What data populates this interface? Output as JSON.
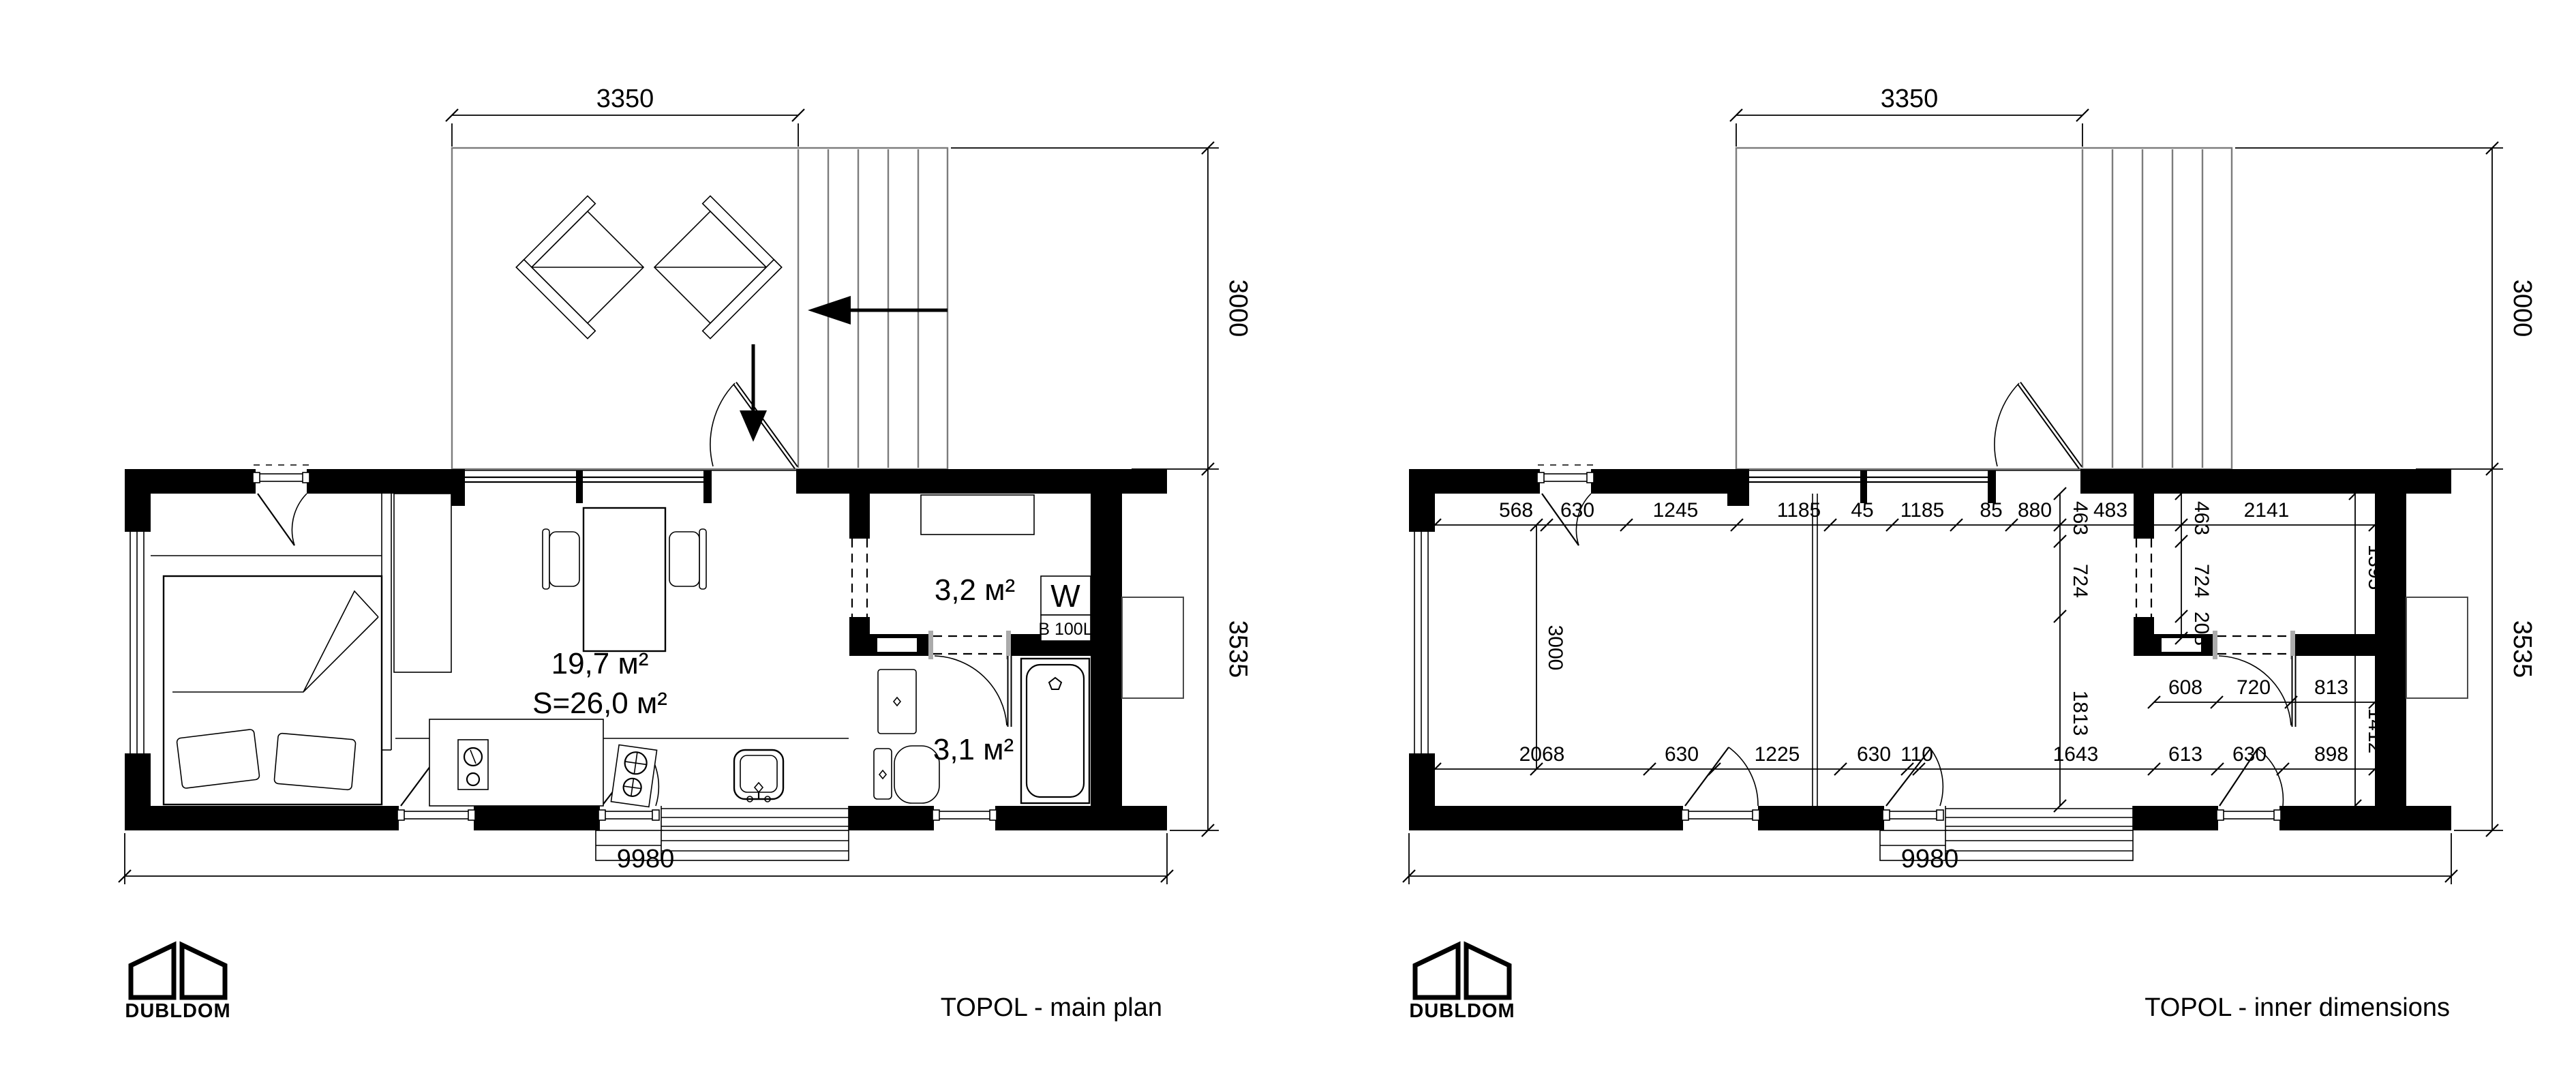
{
  "logo": {
    "name": "DUBLDOM"
  },
  "left": {
    "title": "TOPOL - main plan",
    "dim_terrace_width": "3350",
    "dim_terrace_depth": "3000",
    "dim_house_depth": "3535",
    "dim_total_width": "9980",
    "label_living": "19,7 м²",
    "label_total": "S=26,0 м²",
    "label_hall": "3,2 м²",
    "label_bath": "3,1 м²",
    "label_boiler": "W",
    "label_boiler_volume": "B 100L"
  },
  "right": {
    "title": "TOPOL - inner dimensions",
    "dim_terrace_width": "3350",
    "dim_terrace_depth": "3000",
    "dim_house_depth": "3535",
    "dim_total_width": "9980",
    "dim_room_width": "3000",
    "top_chain": [
      "568",
      "630",
      "1245",
      "1185",
      "45",
      "1185",
      "85",
      "880"
    ],
    "hall_top_chain": [
      "483",
      "2141"
    ],
    "left_v_chain": [
      "463",
      "724",
      "1813"
    ],
    "mid_v_chain": [
      "463",
      "724",
      "208"
    ],
    "right_v_chain": [
      "1395",
      "1412"
    ],
    "bath_top_chain": [
      "608",
      "720",
      "813"
    ],
    "bottom_chain": [
      "2068",
      "630",
      "1225",
      "630",
      "110",
      "1643"
    ],
    "bath_bottom_chain": [
      "613",
      "630",
      "898"
    ]
  }
}
